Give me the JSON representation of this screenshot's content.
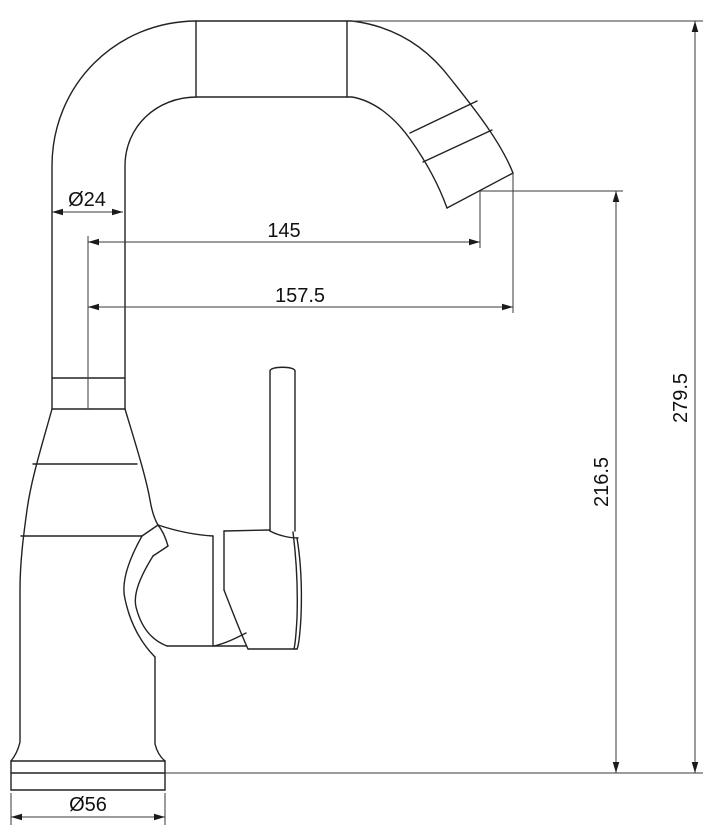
{
  "drawing": {
    "subject": "single-handle-kitchen-faucet",
    "view": "side-elevation-technical-line-drawing",
    "units_implied": "mm",
    "colors": {
      "background": "#ffffff",
      "outline": "#222222",
      "dimension_line": "#3a3a3a",
      "text": "#111111"
    },
    "dimensions": [
      {
        "id": "spout-tube-diameter",
        "label": "Ø24",
        "orientation": "horizontal"
      },
      {
        "id": "spout-reach-to-outlet-center",
        "label": "145",
        "orientation": "horizontal"
      },
      {
        "id": "spout-reach-to-tip",
        "label": "157.5",
        "orientation": "horizontal"
      },
      {
        "id": "outlet-height-above-deck",
        "label": "216.5",
        "orientation": "vertical"
      },
      {
        "id": "overall-height-above-deck",
        "label": "279.5",
        "orientation": "vertical"
      },
      {
        "id": "base-diameter",
        "label": "Ø56",
        "orientation": "horizontal"
      }
    ]
  }
}
